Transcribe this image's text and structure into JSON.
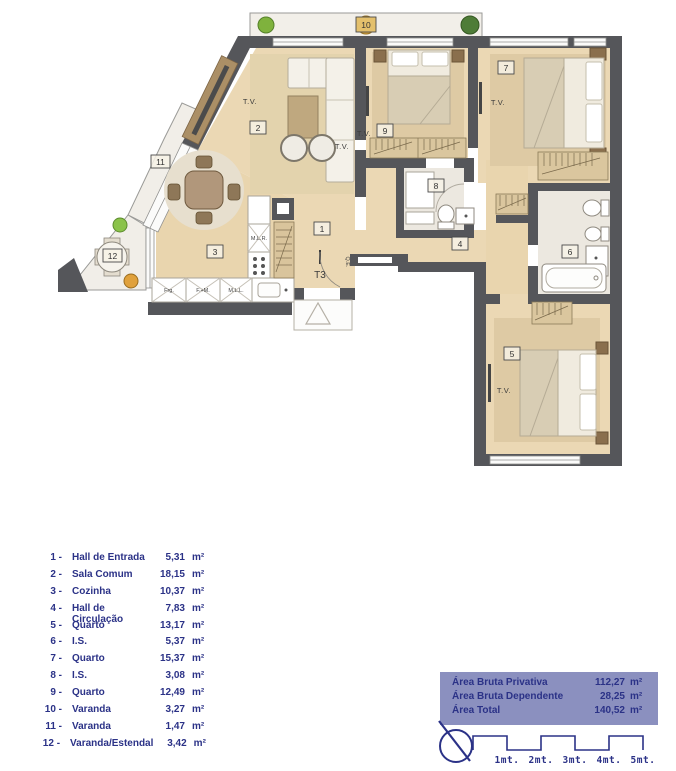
{
  "plan": {
    "rooms": {
      "r1": "1",
      "r2": "2",
      "r3": "3",
      "r4": "4",
      "r5": "5",
      "r6": "6",
      "r7": "7",
      "r8": "8",
      "r9": "9",
      "r10": "10",
      "r11": "11",
      "r12": "12"
    },
    "labels": {
      "tv": "T.V.",
      "type": "T3",
      "qe": "Q.E.",
      "mlr": "M.L.R.",
      "frg": "Frg.",
      "fm": "F.+M.",
      "mll": "M.L.L."
    }
  },
  "legend": {
    "items": [
      {
        "num": "1 -",
        "name": "Hall de Entrada",
        "area": "5,31",
        "unit": "m²"
      },
      {
        "num": "2 -",
        "name": "Sala Comum",
        "area": "18,15",
        "unit": "m²"
      },
      {
        "num": "3 -",
        "name": "Cozinha",
        "area": "10,37",
        "unit": "m²"
      },
      {
        "num": "4 -",
        "name": "Hall de Circulação",
        "area": "7,83",
        "unit": "m²"
      },
      {
        "num": "5 -",
        "name": "Quarto",
        "area": "13,17",
        "unit": "m²"
      },
      {
        "num": "6 -",
        "name": "I.S.",
        "area": "5,37",
        "unit": "m²"
      },
      {
        "num": "7 -",
        "name": "Quarto",
        "area": "15,37",
        "unit": "m²"
      },
      {
        "num": "8 -",
        "name": "I.S.",
        "area": "3,08",
        "unit": "m²"
      },
      {
        "num": "9 -",
        "name": "Quarto",
        "area": "12,49",
        "unit": "m²"
      },
      {
        "num": "10 -",
        "name": "Varanda",
        "area": "3,27",
        "unit": "m²"
      },
      {
        "num": "11 -",
        "name": "Varanda",
        "area": "1,47",
        "unit": "m²"
      },
      {
        "num": "12 -",
        "name": "Varanda/Estendal",
        "area": "3,42",
        "unit": "m²"
      }
    ]
  },
  "summary": {
    "rows": [
      {
        "label": "Área Bruta Privativa",
        "value": "112,27",
        "unit": "m²"
      },
      {
        "label": "Área Bruta Dependente",
        "value": "28,25",
        "unit": "m²"
      },
      {
        "label": "Área Total",
        "value": "140,52",
        "unit": "m²"
      }
    ]
  },
  "scale": {
    "labels": [
      "1mt.",
      "2mt.",
      "3mt.",
      "4mt.",
      "5mt."
    ]
  },
  "colors": {
    "navy": "#2b3287",
    "panel": "#8b90bf",
    "wall": "#55565a",
    "wood": "#ebd8b4"
  }
}
